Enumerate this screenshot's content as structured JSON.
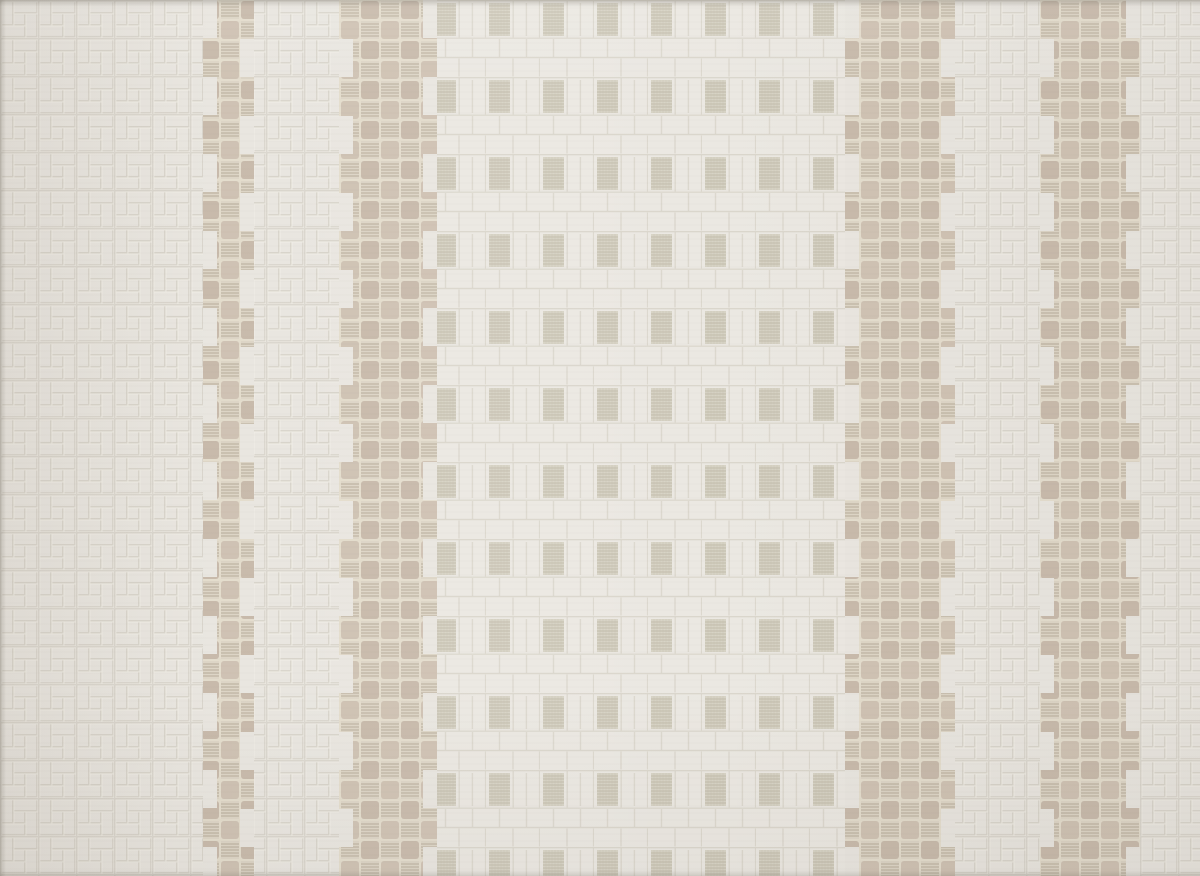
{
  "image": {
    "type": "photograph",
    "subject": "woven jacquard fabric swatch",
    "description": "Close-up photograph of an off-white jacquard upholstery fabric. The ground shows an embossed pinwheel basket-weave texture. A wide central panel is made of small white blocks dotted with woven beige mesh squares in a regular grid. Four vertical beige chenille checkerboard stripes with stepped, zig-zag edges run down the fabric: one narrow stripe near the left, a wide stripe left of center, and two stripes on the right side.",
    "alt_text": "Cream woven fabric with vertical beige checkered chenille stripes and a central grid of mesh squares"
  },
  "palette": {
    "base": "#e9e6e0",
    "groove": "#d9d5cc",
    "grooveHi": "#f4f1ea",
    "panelbase": "#ebe8e2",
    "panelline": "#dcd8ce",
    "panelmesh": "#d7d3c5",
    "panelmeshline": "#c2bcab",
    "stripebg": "#e4ddcd",
    "velvet": "#c8baab",
    "velvetalt": "#cfc2b3",
    "meshfill": "#ddd5c6",
    "meshline": "#b7ac9a"
  },
  "regions": [
    {
      "name": "basket-weave-panel-left",
      "x": 0,
      "width": 203,
      "texture": "basket-weave"
    },
    {
      "name": "accent-stripe-narrow",
      "x": 203,
      "width": 51,
      "texture": "beige-checkerboard"
    },
    {
      "name": "basket-weave-gap-left",
      "x": 254,
      "width": 85,
      "texture": "basket-weave"
    },
    {
      "name": "accent-stripe-wide-left",
      "x": 339,
      "width": 98,
      "texture": "beige-checkerboard"
    },
    {
      "name": "center-block-panel",
      "x": 437,
      "width": 408,
      "texture": "block-grid-with-mesh-squares"
    },
    {
      "name": "accent-stripe-wide-right",
      "x": 845,
      "width": 110,
      "texture": "beige-checkerboard"
    },
    {
      "name": "basket-weave-gap-right",
      "x": 955,
      "width": 85,
      "texture": "basket-weave"
    },
    {
      "name": "accent-stripe-right",
      "x": 1040,
      "width": 100,
      "texture": "beige-checkerboard"
    },
    {
      "name": "basket-weave-panel-right",
      "x": 1140,
      "width": 60,
      "texture": "basket-weave"
    }
  ]
}
